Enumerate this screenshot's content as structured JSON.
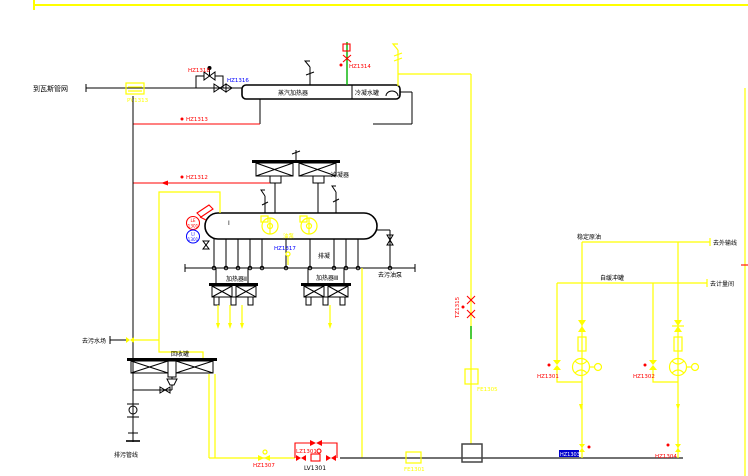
{
  "colors": {
    "background": "#ffffff",
    "line_black": "#000000",
    "line_yellow": "#ffff00",
    "line_red": "#ff0000",
    "line_green": "#00b400",
    "line_blue": "#0000ff",
    "line_gray": "#444444",
    "selected_tag_bg": "#0000cc",
    "selected_tag_text": "#ffffff"
  },
  "labels": {
    "to_gas_network": "到瓦斯管网",
    "vessel_left": "蒸汽加热器",
    "vessel_right": "冷凝水罐",
    "condenser": "冷凝器",
    "recovery_tank": "回收罐",
    "to_sewage": "去污水场",
    "drain_cap": "排污管线",
    "to_sump_pump": "去污油泵",
    "heater_left": "加热器Ⅱ",
    "heater_right": "加热器Ⅲ",
    "drain_note": "排凝",
    "pump_note": "油泵",
    "drum_mark": "Ⅰ",
    "line1_start": "稳定原油",
    "line1_end": "去外输线",
    "line2_mid": "自缓冲罐",
    "line2_end": "去计量间"
  },
  "tags": {
    "pv1313": "PV1313",
    "hz1318": "HZ1318",
    "hz1316": "HZ1316",
    "hz1314": "HZ1314",
    "hz1313": "HZ1313",
    "hz1312": "HZ1312",
    "hz1317": "HZ1317",
    "tz1315": "TZ1315",
    "fe1305": "FE1305",
    "fe1301": "FE1301",
    "hz1307": "HZ1307",
    "lz1301": "LZ1301",
    "lv1301": "LV1301",
    "hz1301": "HZ1301",
    "hz1302": "HZ1302",
    "hz1303": "HZ1303",
    "hz1304": "HZ1304",
    "le_top": "LE",
    "le_num": "1301",
    "li_top": "LI",
    "li_num": "1301"
  }
}
